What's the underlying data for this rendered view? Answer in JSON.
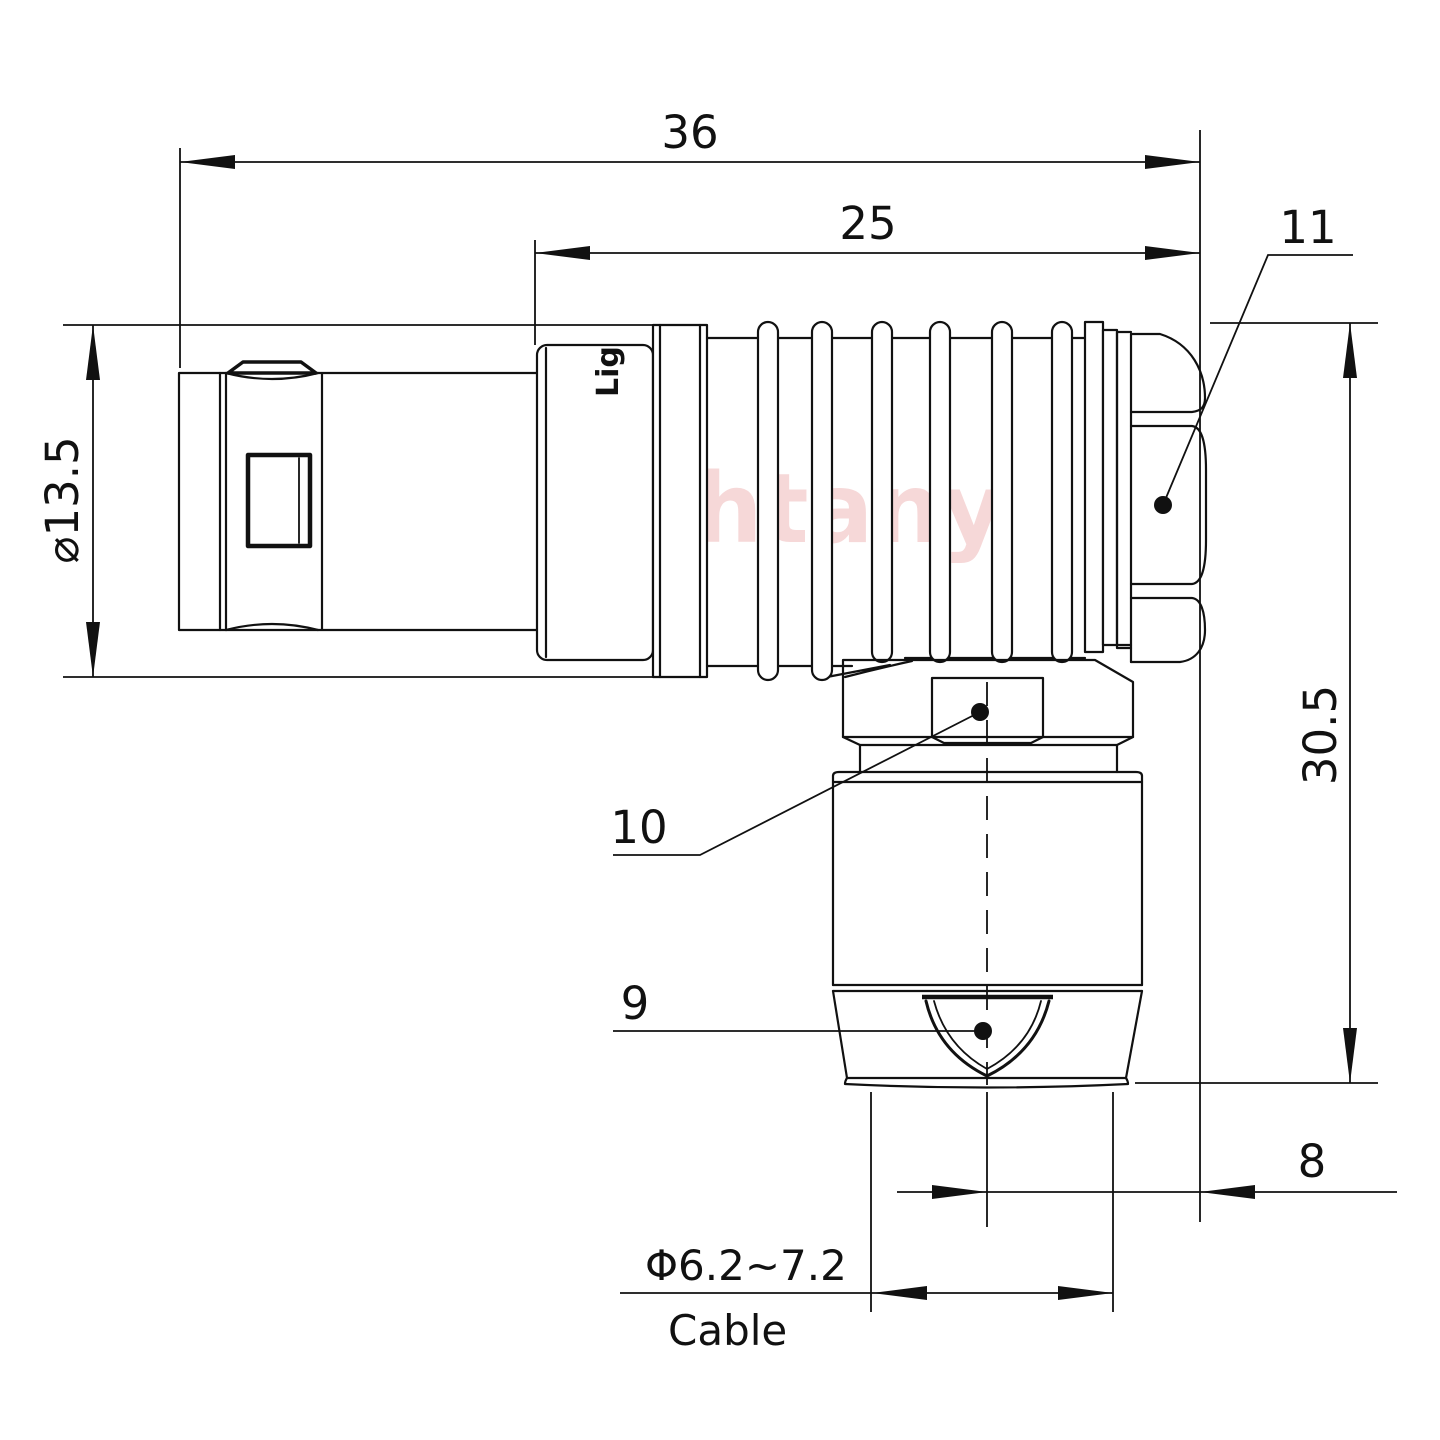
{
  "drawing": {
    "title": "Right-angle push-pull connector plug - dimensioned side view",
    "watermark": "Lightany",
    "logo_print": "Lig",
    "dimensions": {
      "overall_length": "36",
      "body_length": "25",
      "backnut_ref": "11",
      "front_diameter": "⌀13.5",
      "height": "30.5",
      "elbow_nut_ref": "10",
      "bushing_ref": "9",
      "offset": "8",
      "cable_range": "Φ6.2~7.2",
      "cable_label": "Cable"
    },
    "colors": {
      "line": "#111111",
      "background": "#ffffff",
      "watermark_pink": "#e89a9a"
    }
  }
}
